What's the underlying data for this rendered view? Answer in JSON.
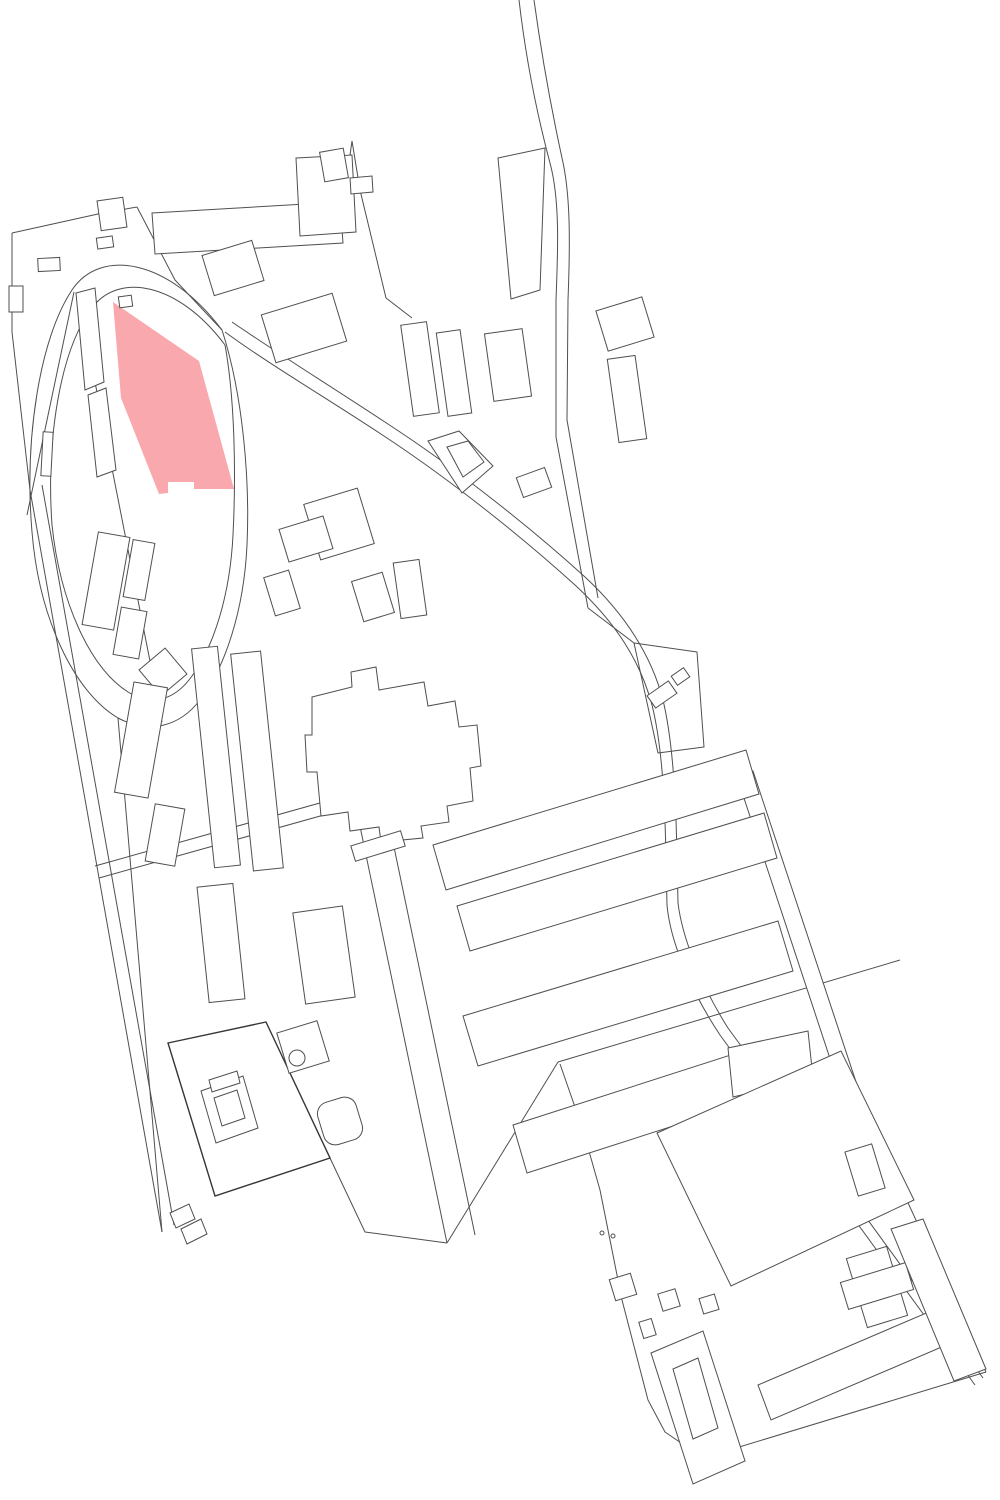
{
  "map": {
    "title": "site-plan-figure-ground",
    "canvas": {
      "width": 1000,
      "height": 1500
    },
    "palette": {
      "background": "#ffffff",
      "line": "#4f4f4f",
      "line_heavy": "#353535",
      "highlight_fill": "#f9a9ad"
    },
    "highlight_parcel": {
      "name": "highlighted-parcel",
      "points": "113,302 199,361 234,489 194,489 194,482 168,482 168,493 159,494 121,398"
    },
    "roads": [
      {
        "name": "road-top-curve-west-edge",
        "d": "M519,0 C526,60 538,118 550,163 C560,200 558,250 556,300 L556,437 L588,608"
      },
      {
        "name": "road-top-curve-east-edge",
        "d": "M534,0 C542,58 552,112 562,158 C571,196 570,248 568,300 L567,420 L598,598"
      },
      {
        "name": "road-main-diagonal-west-edge",
        "d": "M225,332 C270,365 330,400 390,440 C450,480 520,535 575,585 C615,622 640,660 652,705 C662,745 665,800 666,860 L667,905 C670,940 690,990 720,1035 L975,1385"
      },
      {
        "name": "road-main-diagonal-east-edge",
        "d": "M232,322 C280,355 340,392 400,432 C460,472 530,527 585,577 C628,617 652,658 663,700 C673,742 676,800 677,858 L678,903 C682,936 700,984 728,1028 L983,1378"
      },
      {
        "name": "loop-road-outer-edge",
        "d": "M222,330 C168,258 100,248 72,290 C40,338 24,438 32,532 C39,618 74,692 118,718 C150,735 180,726 200,700 C225,668 244,610 247,545 C250,480 243,395 222,330"
      },
      {
        "name": "loop-road-inner-edge",
        "d": "M225,345 C178,282 118,272 92,308 C60,350 46,440 52,525 C60,602 90,668 128,692 C152,707 175,700 192,676 C214,646 230,595 233,535 C236,475 235,400 225,345"
      },
      {
        "name": "loop-chord-west",
        "d": "M74,292 L27,515"
      },
      {
        "name": "loop-chord-east",
        "d": "M78,296 L162,722"
      },
      {
        "name": "boundary-top-left",
        "d": "M12,233 L98,214 L137,207"
      },
      {
        "name": "boundary-top-left-drop",
        "d": "M12,233 L12,332 L30,490"
      },
      {
        "name": "parcel-line-loop-top",
        "d": "M137,207 L175,280 L222,330"
      },
      {
        "name": "boundary-west-outer",
        "d": "M30,490 L162,1232"
      },
      {
        "name": "boundary-west-inner",
        "d": "M42,485 L174,1225"
      },
      {
        "name": "boundary-west-loop-tail",
        "d": "M118,718 L162,1232"
      },
      {
        "name": "cross-street-north-edge",
        "d": "M95,866 L352,794"
      },
      {
        "name": "cross-street-south-edge",
        "d": "M99,878 L356,806"
      },
      {
        "name": "central-street-west-edge",
        "d": "M352,788 L447,1243"
      },
      {
        "name": "central-street-east-edge",
        "d": "M380,780 L475,1235"
      },
      {
        "name": "parcel-line-top-center-step",
        "d": "M352,141 L360,190 L386,298 L412,318"
      },
      {
        "name": "parcel-line-top-center-link",
        "d": "M343,204 L352,141"
      },
      {
        "name": "parcel-trapezoid-top-center",
        "d": "M498,158 L545,148 L540,290 L511,299 Z"
      },
      {
        "name": "parcel-quad-east-mid",
        "d": "M634,643 L697,652 L704,747 L658,753 Z"
      },
      {
        "name": "road-fan-link-east",
        "d": "M588,608 L634,643"
      },
      {
        "name": "boundary-southeast-top",
        "d": "M558,1062 L900,960"
      },
      {
        "name": "boundary-southeast-west",
        "d": "M560,1064 L583,1130 L600,1190 L622,1300 L648,1400 L665,1432 L703,1458"
      },
      {
        "name": "boundary-southeast-bottom",
        "d": "M703,1458 L986,1372"
      },
      {
        "name": "boundary-southeast-right",
        "d": "M862,1103 L986,1372"
      },
      {
        "name": "street-edge-slab-zone",
        "d": "M447,1243 L558,1062"
      },
      {
        "name": "boundary-bottom-left-link",
        "d": "M215,1196 L330,1158 L365,1232 L447,1243"
      }
    ],
    "buildings": [
      {
        "name": "building-topleft-slab",
        "kind": "polygon",
        "points": "152,213 340,202 343,243 155,254"
      },
      {
        "name": "building-topleft-annex",
        "kind": "polygon",
        "points": "296,158 352,155 356,232 300,236"
      },
      {
        "name": "building-topleft-arm",
        "kind": "polygon",
        "points": "350,178 372,176 373,192 351,194"
      },
      {
        "name": "building-topleft-small-1",
        "kind": "rect",
        "x": 97,
        "y": 237,
        "w": 16,
        "h": 11,
        "rot": -8
      },
      {
        "name": "building-topleft-small-2",
        "kind": "rect",
        "x": 38,
        "y": 258,
        "w": 22,
        "h": 13,
        "rot": -3
      },
      {
        "name": "building-topleft-small-3",
        "kind": "rect",
        "x": 9,
        "y": 286,
        "w": 14,
        "h": 26,
        "rot": 0
      },
      {
        "name": "building-topleft-small-4",
        "kind": "rect",
        "x": 119,
        "y": 296,
        "w": 13,
        "h": 11,
        "rot": -8
      },
      {
        "name": "building-topleft-notched",
        "kind": "rect",
        "x": 99,
        "y": 199,
        "w": 26,
        "h": 30,
        "rot": -8
      },
      {
        "name": "building-topcenter-small",
        "kind": "rect",
        "x": 322,
        "y": 150,
        "w": 24,
        "h": 30,
        "rot": -10
      },
      {
        "name": "building-topcenter-slab-1",
        "kind": "rect",
        "x": 407,
        "y": 323,
        "w": 26,
        "h": 92,
        "rot": -8
      },
      {
        "name": "building-topcenter-slab-2",
        "kind": "rect",
        "x": 442,
        "y": 331,
        "w": 24,
        "h": 84,
        "rot": -8
      },
      {
        "name": "building-topcenter-block",
        "kind": "rect",
        "x": 489,
        "y": 331,
        "w": 38,
        "h": 68,
        "rot": -8
      },
      {
        "name": "building-diamond-on-road",
        "kind": "polygon",
        "points": "428,441 459,431 493,466 462,493"
      },
      {
        "name": "building-diamond-inner",
        "kind": "polygon",
        "points": "447,447 468,441 484,462 463,477"
      },
      {
        "name": "building-roadside-small",
        "kind": "rect",
        "x": 519,
        "y": 472,
        "w": 30,
        "h": 21,
        "rot": -20
      },
      {
        "name": "building-loop-north-1",
        "kind": "rect",
        "x": 207,
        "y": 247,
        "w": 52,
        "h": 42,
        "rot": -17
      },
      {
        "name": "building-loop-north-2",
        "kind": "rect",
        "x": 267,
        "y": 303,
        "w": 74,
        "h": 50,
        "rot": -17
      },
      {
        "name": "building-loop-strip-1",
        "kind": "polygon",
        "points": "76,293 95,288 104,382 85,390"
      },
      {
        "name": "building-loop-strip-2",
        "kind": "polygon",
        "points": "88,395 106,388 116,470 97,477"
      },
      {
        "name": "building-loop-strip-3",
        "kind": "rect",
        "x": 42,
        "y": 432,
        "w": 10,
        "h": 44,
        "rot": 3
      },
      {
        "name": "building-loop-square",
        "kind": "rect",
        "x": 146,
        "y": 655,
        "w": 34,
        "h": 34,
        "rot": -40
      },
      {
        "name": "building-leftcol-1",
        "kind": "rect",
        "x": 90,
        "y": 534,
        "w": 32,
        "h": 94,
        "rot": 10
      },
      {
        "name": "building-leftcol-2",
        "kind": "rect",
        "x": 128,
        "y": 541,
        "w": 22,
        "h": 58,
        "rot": 10
      },
      {
        "name": "building-leftcol-3",
        "kind": "rect",
        "x": 117,
        "y": 609,
        "w": 26,
        "h": 48,
        "rot": 10
      },
      {
        "name": "building-leftcol-4",
        "kind": "rect",
        "x": 124,
        "y": 684,
        "w": 34,
        "h": 112,
        "rot": 10
      },
      {
        "name": "building-leftcol-5",
        "kind": "rect",
        "x": 150,
        "y": 806,
        "w": 30,
        "h": 58,
        "rot": 10
      },
      {
        "name": "building-mid-stepped",
        "kind": "rect",
        "x": 311,
        "y": 495,
        "w": 56,
        "h": 58,
        "rot": -17
      },
      {
        "name": "building-mid-small-1",
        "kind": "rect",
        "x": 269,
        "y": 573,
        "w": 26,
        "h": 40,
        "rot": -17
      },
      {
        "name": "building-mid-small-2",
        "kind": "rect",
        "x": 397,
        "y": 561,
        "w": 26,
        "h": 56,
        "rot": -8
      },
      {
        "name": "building-mid-small-3",
        "kind": "rect",
        "x": 357,
        "y": 576,
        "w": 32,
        "h": 42,
        "rot": -17
      },
      {
        "name": "building-mid-block",
        "kind": "rect",
        "x": 283,
        "y": 522,
        "w": 46,
        "h": 34,
        "rot": -17
      },
      {
        "name": "building-midcol-slab-1",
        "kind": "rect",
        "x": 203,
        "y": 647,
        "w": 26,
        "h": 220,
        "rot": -6
      },
      {
        "name": "building-midcol-slab-2",
        "kind": "rect",
        "x": 242,
        "y": 652,
        "w": 30,
        "h": 218,
        "rot": -6
      },
      {
        "name": "building-central-blob",
        "kind": "polygon",
        "points": "312,697 352,687 351,672 376,667 379,690 424,682 428,706 455,701 459,727 477,725 481,766 470,768 473,801 447,806 449,822 421,826 423,838 381,842 379,827 350,831 348,812 321,816 317,772 307,772 305,735 312,735"
      },
      {
        "name": "building-central-tail",
        "kind": "rect",
        "x": 352,
        "y": 838,
        "w": 52,
        "h": 16,
        "rot": -17
      },
      {
        "name": "building-eastmid-stepped",
        "kind": "rect",
        "x": 601,
        "y": 303,
        "w": 48,
        "h": 42,
        "rot": -17
      },
      {
        "name": "building-eastmid-slab",
        "kind": "rect",
        "x": 613,
        "y": 357,
        "w": 28,
        "h": 84,
        "rot": -8
      },
      {
        "name": "building-eastparcel-small-1",
        "kind": "rect",
        "x": 649,
        "y": 687,
        "w": 26,
        "h": 15,
        "rot": -35
      },
      {
        "name": "building-eastparcel-small-2",
        "kind": "rect",
        "x": 673,
        "y": 671,
        "w": 15,
        "h": 11,
        "rot": -35
      },
      {
        "name": "building-east-strip",
        "kind": "polygon",
        "points": "737,777 753,771 863,1103 847,1110"
      },
      {
        "name": "building-slab-row-a",
        "kind": "polygon",
        "points": "433,845 746,750 759,794 446,890"
      },
      {
        "name": "building-slab-row-b",
        "kind": "polygon",
        "points": "457,906 764,813 777,858 470,951"
      },
      {
        "name": "building-slab-row-c",
        "kind": "polygon",
        "points": "463,1016 778,921 793,971 478,1066"
      },
      {
        "name": "building-slab-row-d",
        "kind": "polygon",
        "points": "513,1125 793,1035 807,1083 527,1173"
      },
      {
        "name": "building-slab-row-e",
        "kind": "polygon",
        "points": "728,1048 808,1031 813,1078 733,1097"
      },
      {
        "name": "building-big-box",
        "kind": "polygon",
        "points": "657,1133 841,1051 914,1200 731,1286"
      },
      {
        "name": "building-bl-upper-1",
        "kind": "rect",
        "x": 203,
        "y": 885,
        "w": 36,
        "h": 116,
        "rot": -6
      },
      {
        "name": "building-bl-upper-2",
        "kind": "rect",
        "x": 299,
        "y": 909,
        "w": 50,
        "h": 92,
        "rot": -8
      },
      {
        "name": "courtyard-block-outline",
        "kind": "polygon",
        "points": "168,1043 266,1022 330,1158 215,1196",
        "heavy": true
      },
      {
        "name": "building-courtyard-upper",
        "kind": "rect",
        "x": 282,
        "y": 1026,
        "w": 42,
        "h": 42,
        "rot": -17
      },
      {
        "name": "building-courtyard-ring",
        "kind": "polygon",
        "points": "201,1091 243,1076 258,1128 216,1143"
      },
      {
        "name": "building-courtyard-ring-hole",
        "kind": "polygon",
        "points": "214,1098 237,1090 245,1118 222,1126",
        "hole": true
      },
      {
        "name": "building-courtyard-bar",
        "kind": "polygon",
        "points": "209,1080 237,1071 240,1083 212,1092"
      },
      {
        "name": "building-courtyard-circle",
        "kind": "circle",
        "cx": 297,
        "cy": 1058,
        "r": 8
      },
      {
        "name": "building-courtyard-rounded",
        "kind": "rect",
        "x": 320,
        "y": 1099,
        "w": 40,
        "h": 44,
        "rot": -17,
        "rx": 12
      },
      {
        "name": "building-southwest-tip-1",
        "kind": "polygon",
        "points": "170,1213 189,1204 195,1219 176,1228"
      },
      {
        "name": "building-southwest-tip-2",
        "kind": "polygon",
        "points": "181,1229 201,1219 207,1234 187,1244"
      },
      {
        "name": "building-se-square-1",
        "kind": "rect",
        "x": 612,
        "y": 1276,
        "w": 22,
        "h": 22,
        "rot": -17
      },
      {
        "name": "building-se-square-2",
        "kind": "rect",
        "x": 660,
        "y": 1291,
        "w": 18,
        "h": 18,
        "rot": -17
      },
      {
        "name": "building-se-square-3",
        "kind": "rect",
        "x": 701,
        "y": 1296,
        "w": 16,
        "h": 16,
        "rot": -17
      },
      {
        "name": "building-se-square-4",
        "kind": "rect",
        "x": 641,
        "y": 1320,
        "w": 13,
        "h": 17,
        "rot": -17
      },
      {
        "name": "building-se-u-block",
        "kind": "polygon",
        "points": "651,1353 703,1331 745,1461 693,1484"
      },
      {
        "name": "building-se-u-courtyard",
        "kind": "polygon",
        "points": "673,1369 698,1358 718,1428 693,1439",
        "hole": true
      },
      {
        "name": "building-se-long-slab",
        "kind": "polygon",
        "points": "758,1385 931,1311 944,1346 771,1420"
      },
      {
        "name": "building-se-cross-vertical",
        "kind": "rect",
        "x": 856,
        "y": 1251,
        "w": 42,
        "h": 72,
        "rot": -17
      },
      {
        "name": "building-se-cross-horizontal",
        "kind": "rect",
        "x": 843,
        "y": 1272,
        "w": 68,
        "h": 28,
        "rot": -17
      },
      {
        "name": "building-se-small-top",
        "kind": "rect",
        "x": 851,
        "y": 1147,
        "w": 28,
        "h": 46,
        "rot": -17
      },
      {
        "name": "building-se-right-strip",
        "kind": "polygon",
        "points": "891,1229 923,1219 986,1369 954,1381"
      },
      {
        "name": "map-dot-1",
        "kind": "circle",
        "cx": 602,
        "cy": 1233,
        "r": 2
      },
      {
        "name": "map-dot-2",
        "kind": "circle",
        "cx": 613,
        "cy": 1236,
        "r": 2
      }
    ]
  }
}
